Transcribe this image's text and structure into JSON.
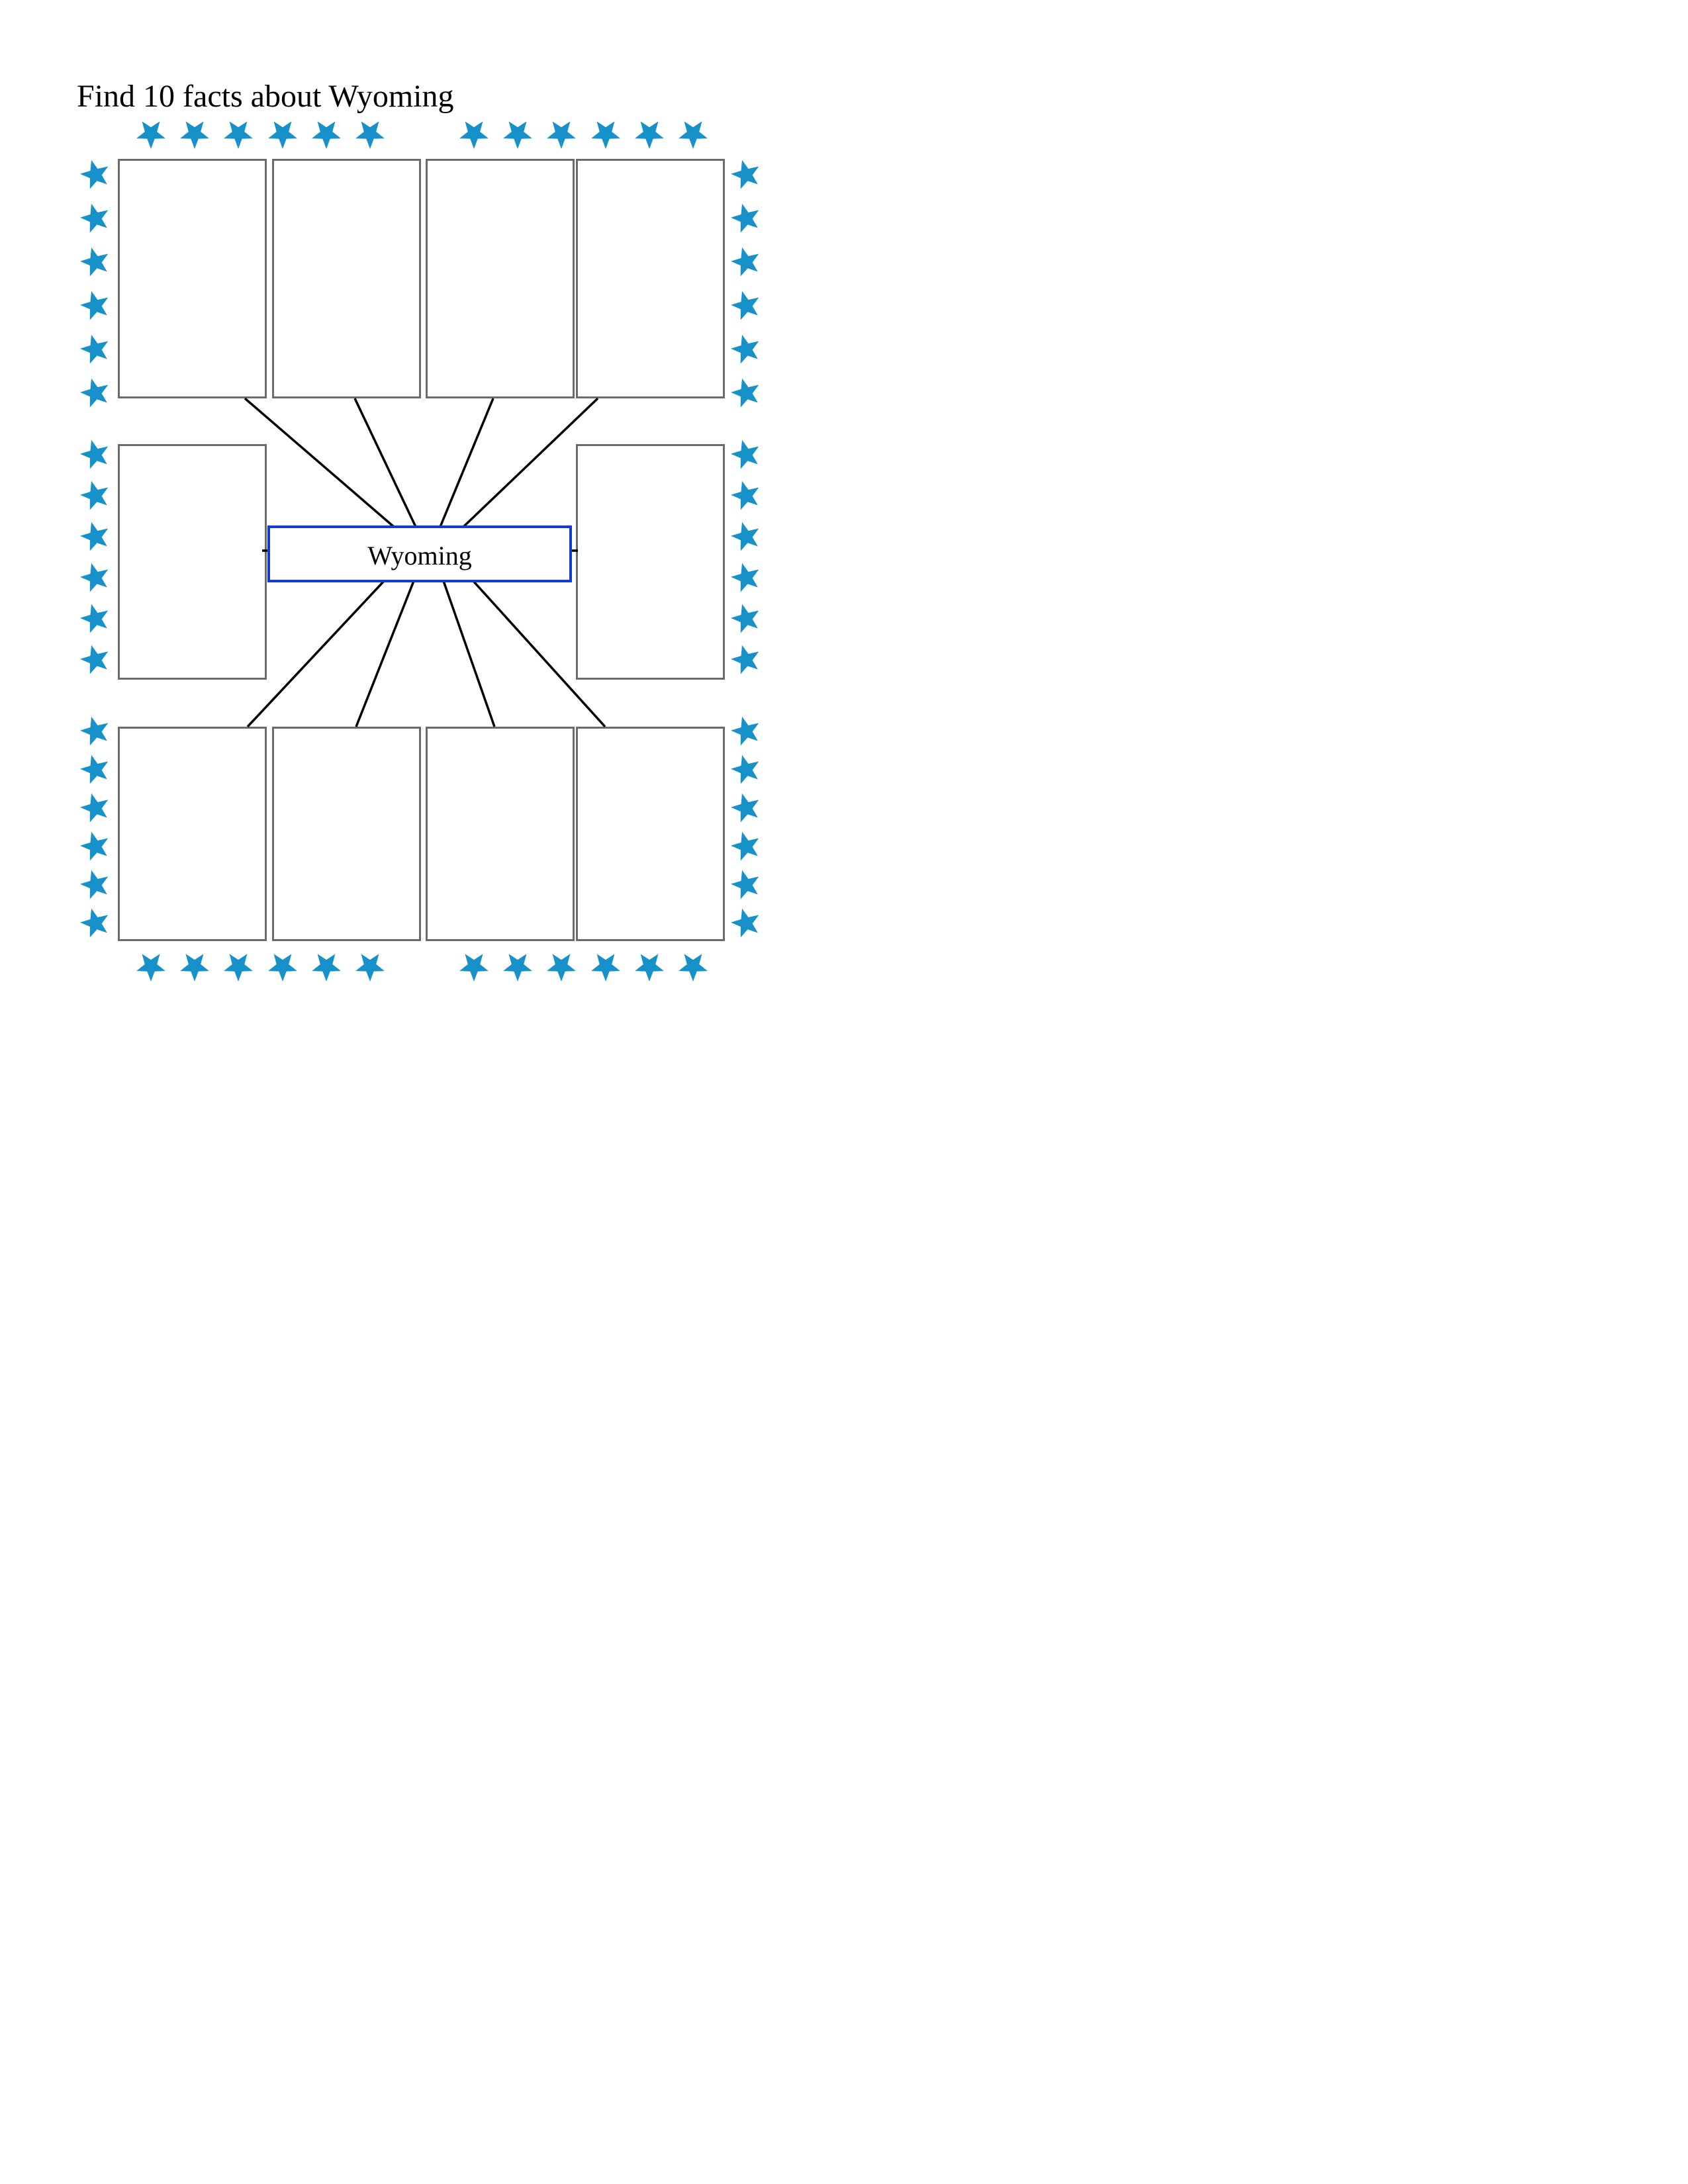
{
  "title": {
    "text": "Find 10 facts about Wyoming"
  },
  "center_box": {
    "label": "Wyoming",
    "border_color": "#123bd0"
  },
  "fact_boxes": {
    "count": 10,
    "border_color": "#6b6b6b",
    "items": [
      {
        "id": "top-1",
        "value": ""
      },
      {
        "id": "top-2",
        "value": ""
      },
      {
        "id": "top-3",
        "value": ""
      },
      {
        "id": "top-4",
        "value": ""
      },
      {
        "id": "middle-left",
        "value": ""
      },
      {
        "id": "middle-right",
        "value": ""
      },
      {
        "id": "bottom-1",
        "value": ""
      },
      {
        "id": "bottom-2",
        "value": ""
      },
      {
        "id": "bottom-3",
        "value": ""
      },
      {
        "id": "bottom-4",
        "value": ""
      }
    ]
  },
  "connectors": {
    "count": 10,
    "color": "#000000"
  },
  "stars": {
    "color": "#1791c9",
    "top_row_count": 12,
    "bottom_row_count": 12,
    "left_column_count": 18,
    "right_column_count": 18
  }
}
